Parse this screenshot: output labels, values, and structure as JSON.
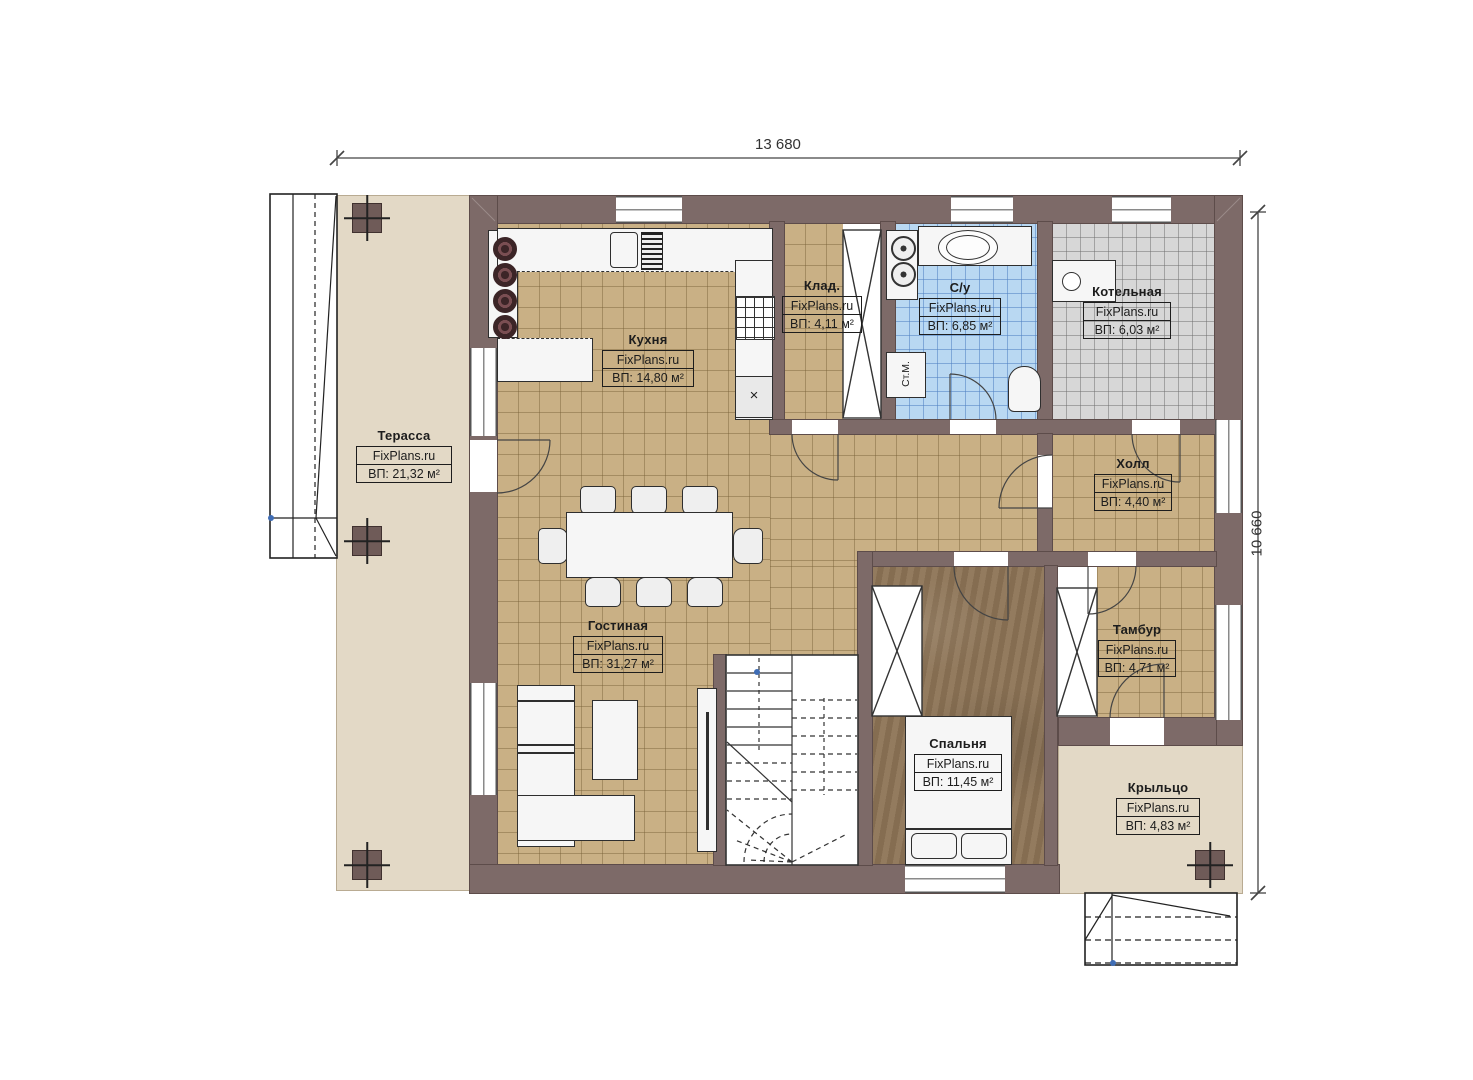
{
  "watermark": "FixPlans.ru",
  "dimensions": {
    "width_top": "13 680",
    "height_right": "10 660"
  },
  "rooms": {
    "terrace": {
      "name": "Терасса",
      "area": "ВП: 21,32 м²"
    },
    "kitchen": {
      "name": "Кухня",
      "area": "ВП: 14,80 м²"
    },
    "storage": {
      "name": "Клад.",
      "area": "ВП: 4,11 м²"
    },
    "bathroom": {
      "name": "С/у",
      "area": "ВП: 6,85 м²"
    },
    "boiler": {
      "name": "Котельная",
      "area": "ВП: 6,03 м²"
    },
    "hall": {
      "name": "Холл",
      "area": "ВП: 4,40 м²"
    },
    "tambour": {
      "name": "Тамбур",
      "area": "ВП: 4,71 м²"
    },
    "living": {
      "name": "Гостиная",
      "area": "ВП: 31,27 м²"
    },
    "bedroom": {
      "name": "Спальня",
      "area": "ВП: 11,45 м²"
    },
    "porch": {
      "name": "Крыльцо",
      "area": "ВП: 4,83 м²"
    }
  },
  "labels": {
    "washing_machine": "Ст.М.",
    "cabinet_mark": "×"
  },
  "colors": {
    "wall": "#7d6a68",
    "floor_tile": "#c9b085",
    "floor_bath": "#b9d8f2",
    "floor_boiler": "#d7d7d7",
    "floor_wood": "#8d7456",
    "floor_outdoor": "#e3d9c6"
  }
}
